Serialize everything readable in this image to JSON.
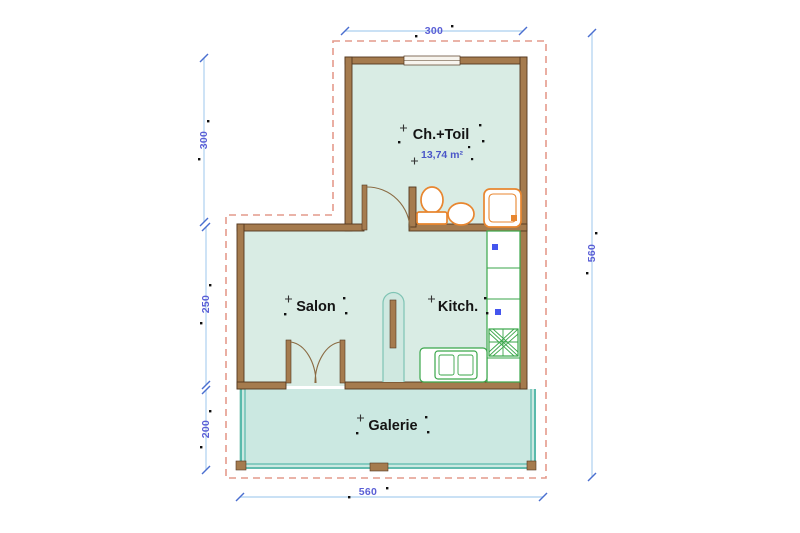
{
  "document": {
    "type": "architectural-floor-plan",
    "background": "#ffffff"
  },
  "rooms": {
    "bedroom": {
      "label": "Ch.+Toil",
      "area": "13,74 m²"
    },
    "living": {
      "label": "Salon"
    },
    "kitchen": {
      "label": "Kitch."
    },
    "gallery": {
      "label": "Galerie"
    }
  },
  "dimensions": {
    "top": "300",
    "left_upper": "300",
    "left_middle": "250",
    "left_lower": "200",
    "right": "560",
    "bottom": "560"
  },
  "colors": {
    "wall": "#a57b4e",
    "wall_edge": "#53381f",
    "room_fill": "#d9ece4",
    "gallery_fill": "#cbe8e1",
    "gallery_rail": "#3fae9e",
    "roof_dash": "#e49a8c",
    "dimension_line": "#b9d7f2",
    "dimension_tick": "#4a6fd0",
    "dimension_text": "#5a5fd6",
    "label_text": "#141414",
    "area_text": "#4a56c8",
    "sanitary_fixture": "#e8862f",
    "kitchen_fixture": "#3aa64a",
    "appliance_marker": "#4455ee"
  }
}
